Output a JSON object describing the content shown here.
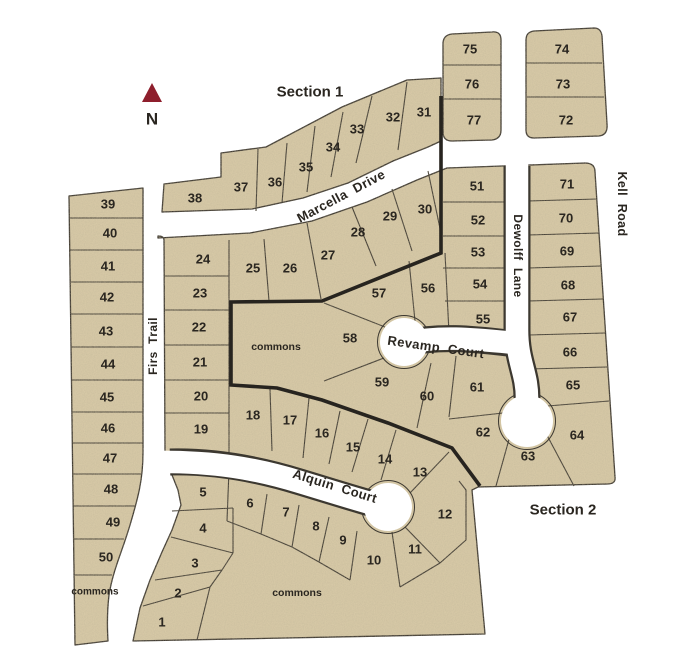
{
  "north": {
    "label": "N"
  },
  "sections": [
    {
      "label": "Section 1",
      "x": 310,
      "y": 92
    },
    {
      "label": "Section 2",
      "x": 563,
      "y": 510
    }
  ],
  "streets": [
    {
      "name": "Marcella  Drive",
      "x": 341,
      "y": 196,
      "rotate": -28,
      "size": 13
    },
    {
      "name": "Firs  Trail",
      "x": 153,
      "y": 346,
      "rotate": -90,
      "size": 12
    },
    {
      "name": "Revamp  Court",
      "x": 436,
      "y": 347,
      "rotate": 8,
      "size": 13
    },
    {
      "name": "Alquin  Court",
      "x": 335,
      "y": 486,
      "rotate": 17,
      "size": 13
    },
    {
      "name": "Dewolff  Lane",
      "x": 518,
      "y": 256,
      "rotate": 90,
      "size": 12
    },
    {
      "name": "Kell  Road",
      "x": 622,
      "y": 204,
      "rotate": 90,
      "size": 12.5
    }
  ],
  "commons_labels": [
    {
      "label": "commons",
      "x": 95,
      "y": 592,
      "size": 10
    },
    {
      "label": "commons",
      "x": 276,
      "y": 347,
      "size": 10.5
    },
    {
      "label": "commons",
      "x": 297,
      "y": 593,
      "size": 10.5
    }
  ],
  "lots": [
    {
      "n": "1",
      "x": 162,
      "y": 622
    },
    {
      "n": "2",
      "x": 178,
      "y": 593
    },
    {
      "n": "3",
      "x": 195,
      "y": 563
    },
    {
      "n": "4",
      "x": 203,
      "y": 528
    },
    {
      "n": "5",
      "x": 203,
      "y": 492
    },
    {
      "n": "6",
      "x": 250,
      "y": 503
    },
    {
      "n": "7",
      "x": 286,
      "y": 512
    },
    {
      "n": "8",
      "x": 316,
      "y": 526
    },
    {
      "n": "9",
      "x": 343,
      "y": 540
    },
    {
      "n": "10",
      "x": 374,
      "y": 560
    },
    {
      "n": "11",
      "x": 415,
      "y": 549
    },
    {
      "n": "12",
      "x": 445,
      "y": 514
    },
    {
      "n": "13",
      "x": 420,
      "y": 472
    },
    {
      "n": "14",
      "x": 385,
      "y": 459
    },
    {
      "n": "15",
      "x": 353,
      "y": 447
    },
    {
      "n": "16",
      "x": 322,
      "y": 433
    },
    {
      "n": "17",
      "x": 290,
      "y": 420
    },
    {
      "n": "18",
      "x": 253,
      "y": 415
    },
    {
      "n": "19",
      "x": 201,
      "y": 429
    },
    {
      "n": "20",
      "x": 201,
      "y": 396
    },
    {
      "n": "21",
      "x": 200,
      "y": 362
    },
    {
      "n": "22",
      "x": 199,
      "y": 327
    },
    {
      "n": "23",
      "x": 200,
      "y": 293
    },
    {
      "n": "24",
      "x": 203,
      "y": 259
    },
    {
      "n": "25",
      "x": 253,
      "y": 268
    },
    {
      "n": "26",
      "x": 290,
      "y": 268
    },
    {
      "n": "27",
      "x": 328,
      "y": 255
    },
    {
      "n": "28",
      "x": 358,
      "y": 232
    },
    {
      "n": "29",
      "x": 390,
      "y": 216
    },
    {
      "n": "30",
      "x": 425,
      "y": 209
    },
    {
      "n": "31",
      "x": 424,
      "y": 112
    },
    {
      "n": "32",
      "x": 393,
      "y": 117
    },
    {
      "n": "33",
      "x": 357,
      "y": 129
    },
    {
      "n": "34",
      "x": 333,
      "y": 147
    },
    {
      "n": "35",
      "x": 306,
      "y": 167
    },
    {
      "n": "36",
      "x": 275,
      "y": 182
    },
    {
      "n": "37",
      "x": 241,
      "y": 187
    },
    {
      "n": "38",
      "x": 195,
      "y": 198
    },
    {
      "n": "39",
      "x": 108,
      "y": 204
    },
    {
      "n": "40",
      "x": 110,
      "y": 233
    },
    {
      "n": "41",
      "x": 108,
      "y": 266
    },
    {
      "n": "42",
      "x": 107,
      "y": 297
    },
    {
      "n": "43",
      "x": 106,
      "y": 331
    },
    {
      "n": "44",
      "x": 108,
      "y": 364
    },
    {
      "n": "45",
      "x": 107,
      "y": 397
    },
    {
      "n": "46",
      "x": 108,
      "y": 428
    },
    {
      "n": "47",
      "x": 110,
      "y": 458
    },
    {
      "n": "48",
      "x": 111,
      "y": 489
    },
    {
      "n": "49",
      "x": 113,
      "y": 522
    },
    {
      "n": "50",
      "x": 106,
      "y": 557
    },
    {
      "n": "51",
      "x": 477,
      "y": 186
    },
    {
      "n": "52",
      "x": 478,
      "y": 220
    },
    {
      "n": "53",
      "x": 478,
      "y": 252
    },
    {
      "n": "54",
      "x": 480,
      "y": 284
    },
    {
      "n": "55",
      "x": 483,
      "y": 319
    },
    {
      "n": "56",
      "x": 428,
      "y": 288
    },
    {
      "n": "57",
      "x": 379,
      "y": 293
    },
    {
      "n": "58",
      "x": 350,
      "y": 338
    },
    {
      "n": "59",
      "x": 382,
      "y": 382
    },
    {
      "n": "60",
      "x": 427,
      "y": 396
    },
    {
      "n": "61",
      "x": 477,
      "y": 387
    },
    {
      "n": "62",
      "x": 483,
      "y": 432
    },
    {
      "n": "63",
      "x": 528,
      "y": 456
    },
    {
      "n": "64",
      "x": 577,
      "y": 435
    },
    {
      "n": "65",
      "x": 573,
      "y": 385
    },
    {
      "n": "66",
      "x": 570,
      "y": 352
    },
    {
      "n": "67",
      "x": 570,
      "y": 317
    },
    {
      "n": "68",
      "x": 568,
      "y": 285
    },
    {
      "n": "69",
      "x": 567,
      "y": 251
    },
    {
      "n": "70",
      "x": 566,
      "y": 218
    },
    {
      "n": "71",
      "x": 567,
      "y": 184
    },
    {
      "n": "72",
      "x": 566,
      "y": 120
    },
    {
      "n": "73",
      "x": 563,
      "y": 84
    },
    {
      "n": "74",
      "x": 562,
      "y": 49
    },
    {
      "n": "75",
      "x": 470,
      "y": 49
    },
    {
      "n": "76",
      "x": 472,
      "y": 84
    },
    {
      "n": "77",
      "x": 474,
      "y": 120
    }
  ],
  "colors": {
    "lot_fill": "#d6c8a6",
    "lot_line": "#3c3830",
    "section_boundary": "#27241f",
    "street": "#ffffff",
    "north_arrow": "#8e1e2c",
    "text": "#2a2620"
  }
}
